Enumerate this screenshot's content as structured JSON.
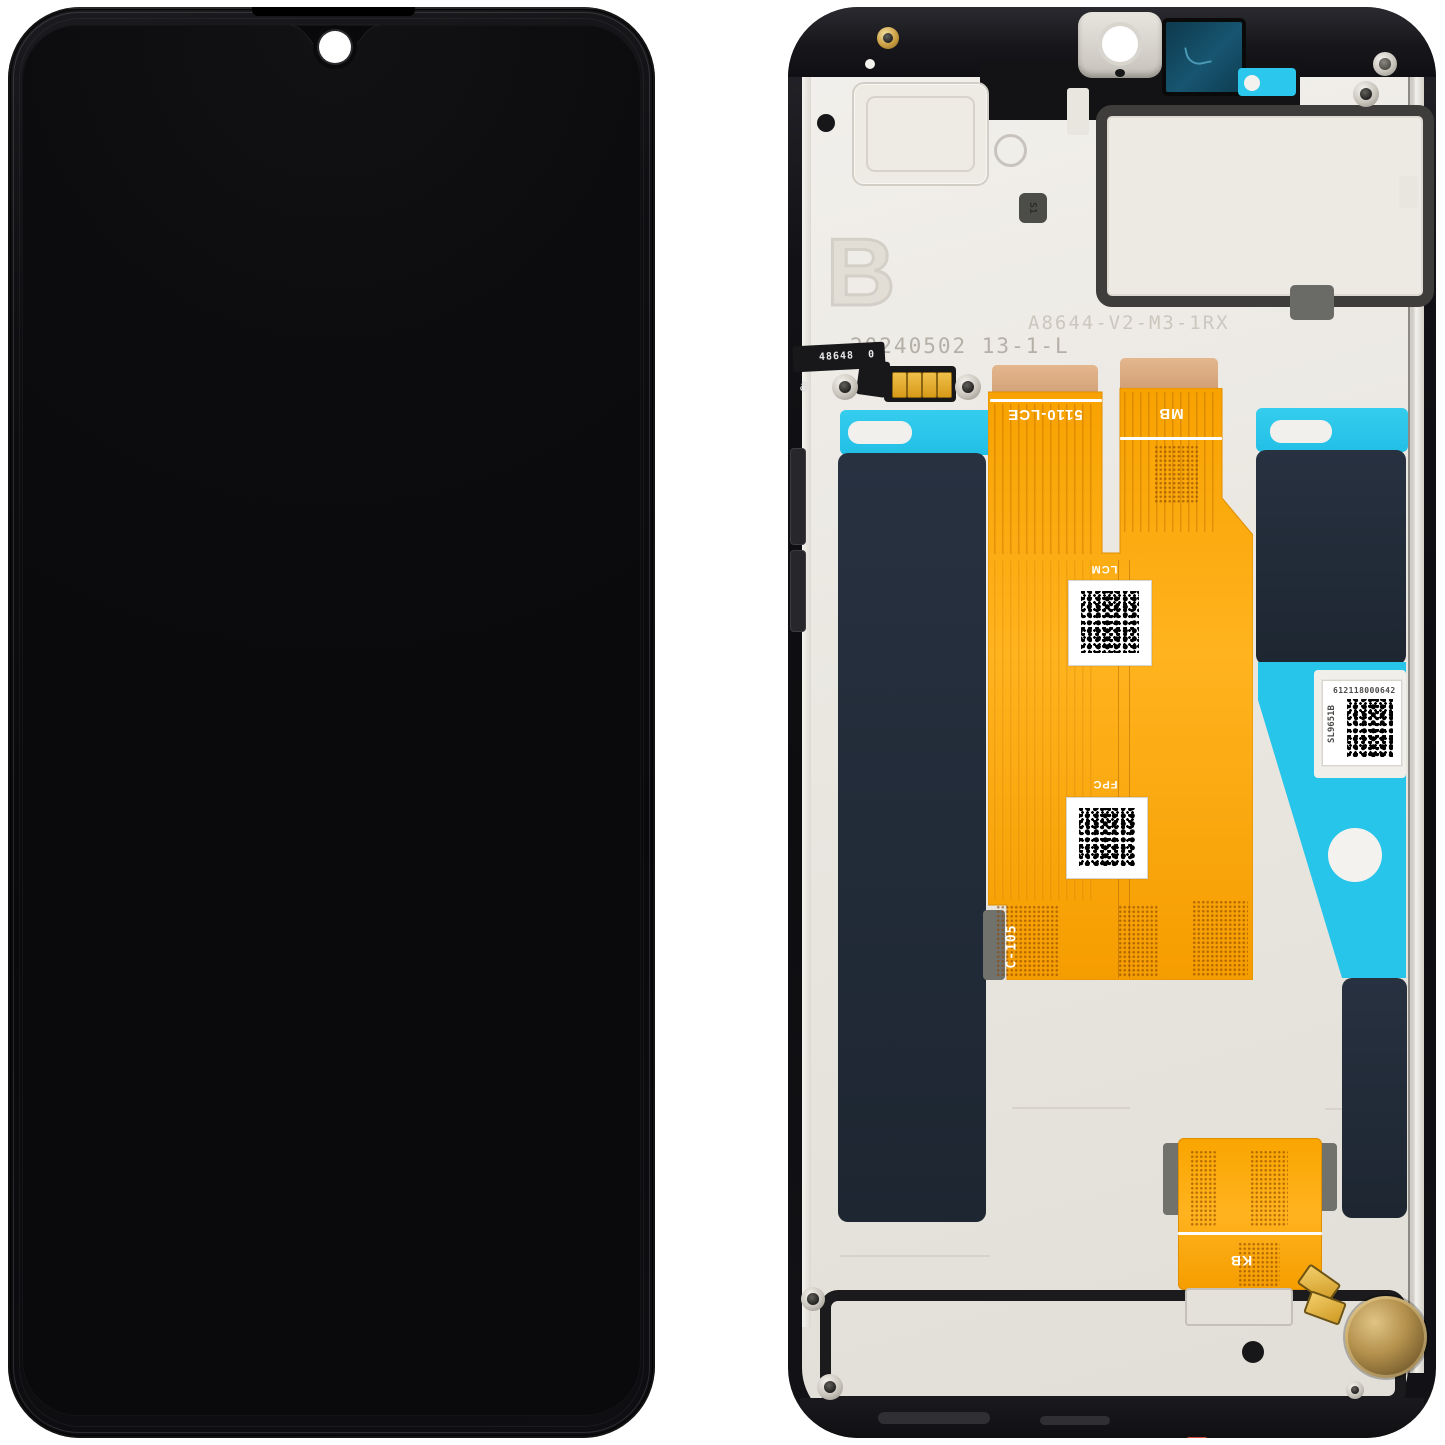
{
  "palette": {
    "background": "#FFFFFF",
    "flex_orange": "#F8A300",
    "flex_orange_light": "#FFB31E",
    "adhesive_cyan": "#27C5EA",
    "pad_navy": "#222D3A",
    "plate_silver": "#EAE7E1",
    "frame_black": "#141418",
    "copper_tan": "#D9A87E",
    "gold_contact": "#E2A92C",
    "camera_window_teal": "#15475D",
    "motor_bronze": "#B08F4C",
    "stamp_gray": "#B5B0A7",
    "accent_red": "#D84B3A"
  },
  "back_view": {
    "flex_labels": {
      "main_left": "5110-LCE",
      "main_right": "MB",
      "lcm": "LCM",
      "fpc": "FPC",
      "keyboard": "KB",
      "vertical_code": "C-105",
      "sub_flex_code": "48648 _0",
      "sub_flex_end": "GR"
    },
    "stamps": {
      "letter": "B",
      "model": "A8644-V2-M3-1RX",
      "date_lot": "20240502 13-1-L",
      "s1": "S1"
    },
    "sticker": {
      "serial": "612118000642",
      "code": "SL9651B"
    }
  }
}
